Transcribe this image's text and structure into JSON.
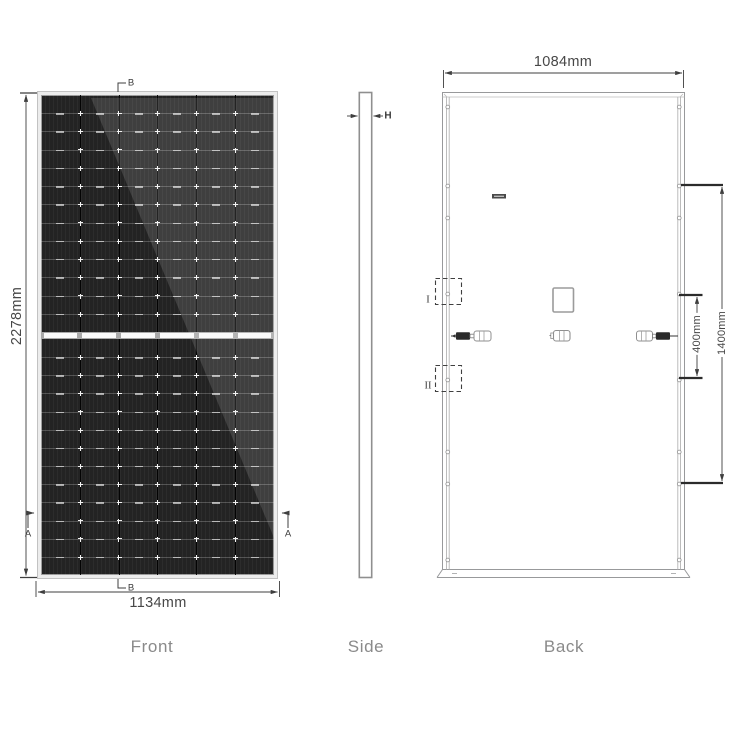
{
  "views": {
    "front": {
      "label": "Front",
      "height_dim": "2278mm",
      "width_dim": "1134mm",
      "marker_a": "A",
      "marker_b": "B",
      "panel": {
        "columns": 6,
        "rows_per_half": 13
      }
    },
    "side": {
      "label": "Side",
      "thickness_marker": "H"
    },
    "back": {
      "label": "Back",
      "width_dim": "1084mm",
      "hole_spacing_inner": "400mm",
      "hole_spacing_outer": "1400mm",
      "detail_marker_1": "I",
      "detail_marker_2": "II"
    }
  },
  "colors": {
    "dimension_line": "#3f3f3f",
    "frame_outline": "#98999b",
    "cell_dark": "#232323",
    "panel_frame": "#ececec",
    "view_label_gray": "#8a8a8a"
  }
}
